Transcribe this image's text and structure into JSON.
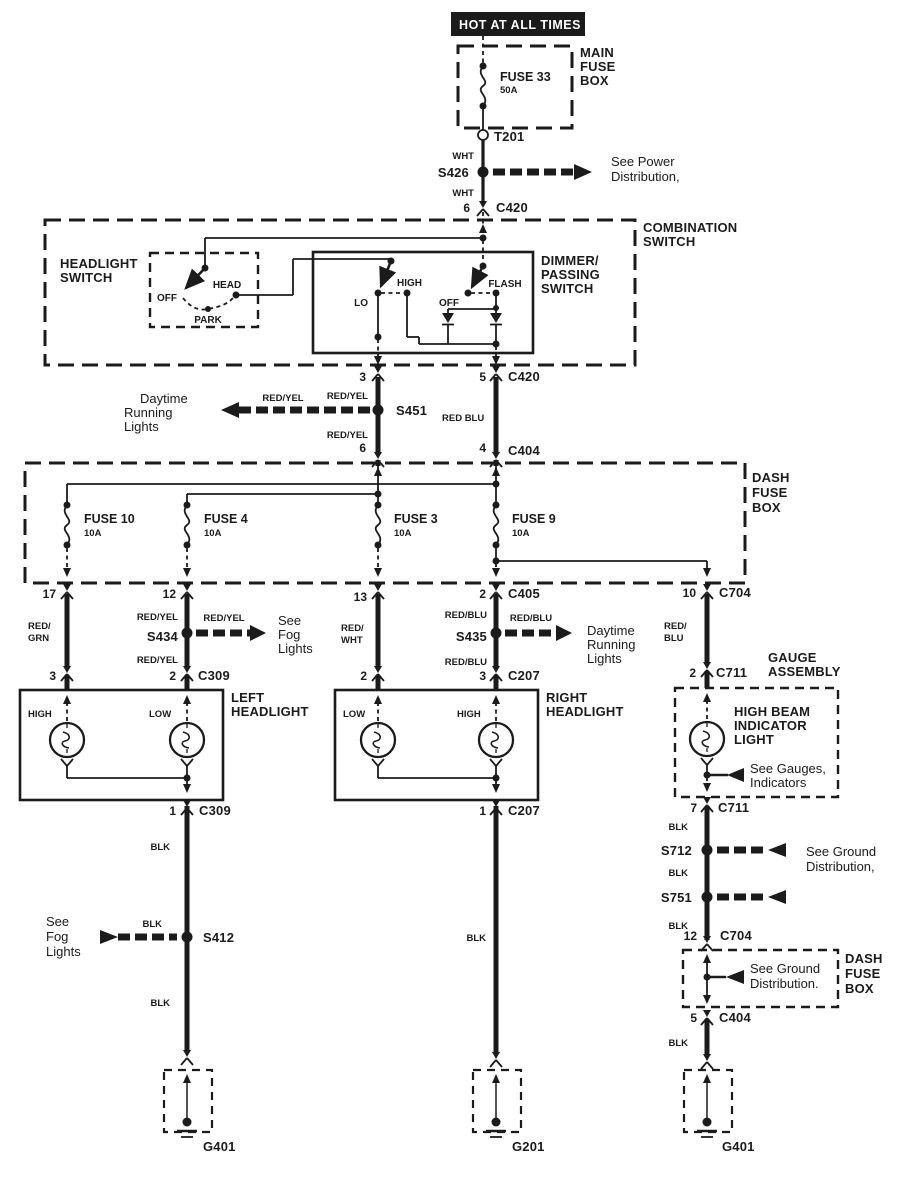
{
  "banner": {
    "text": "HOT AT ALL TIMES"
  },
  "wire": {
    "blk": "BLK",
    "wht": "WHT",
    "red_yel": "RED/YEL",
    "red_blu": "RED/BLU",
    "red_blu_sp": "RED BLU",
    "red1": "RED/",
    "grn": "GRN",
    "wht2": "WHT",
    "blu": "BLU"
  },
  "top": {
    "box_title": [
      "MAIN",
      "FUSE",
      "BOX"
    ],
    "fuse_name": "FUSE 33",
    "fuse_rating": "50A",
    "t201": "T201",
    "s426": "S426",
    "see_power": [
      "See Power",
      "Distribution,"
    ],
    "pin6": "6",
    "c420": "C420"
  },
  "combo": {
    "title": [
      "COMBINATION",
      "SWITCH"
    ],
    "headlight": {
      "title": [
        "HEADLIGHT",
        "SWITCH"
      ],
      "off": "OFF",
      "head": "HEAD",
      "park": "PARK"
    },
    "dimmer": {
      "title": [
        "DIMMER/",
        "PASSING",
        "SWITCH"
      ],
      "lo": "LO",
      "high": "HIGH",
      "off": "OFF",
      "flash": "FLASH"
    }
  },
  "s451_section": {
    "pin3": "3",
    "pin5": "5",
    "c420": "C420",
    "s451": "S451",
    "daytime": [
      "Daytime",
      "Running",
      "Lights"
    ],
    "pin6": "6",
    "pin4": "4",
    "c404": "C404"
  },
  "dashbox": {
    "title": [
      "DASH",
      "FUSE",
      "BOX"
    ],
    "fuses": [
      {
        "name": "FUSE 10",
        "rating": "10A"
      },
      {
        "name": "FUSE 4",
        "rating": "10A"
      },
      {
        "name": "FUSE 3",
        "rating": "10A"
      },
      {
        "name": "FUSE 9",
        "rating": "10A"
      }
    ]
  },
  "row1": {
    "pin17": "17",
    "pin12": "12",
    "pin13": "13",
    "pin2": "2",
    "c405": "C405",
    "pin10": "10",
    "c704": "C704"
  },
  "branches": {
    "s434": "S434",
    "see_fog": [
      "See",
      "Fog",
      "Lights"
    ],
    "s435": "S435",
    "daytime": [
      "Daytime",
      "Running",
      "Lights"
    ]
  },
  "row2": {
    "pin3": "3",
    "pin2a": "2",
    "c309": "C309",
    "pin2b": "2",
    "pin3b": "3",
    "c207": "C207",
    "pin2c": "2",
    "c711": "C711"
  },
  "lh": {
    "title": [
      "LEFT",
      "HEADLIGHT"
    ],
    "high": "HIGH",
    "low": "LOW",
    "pin1": "1",
    "c309": "C309"
  },
  "rh": {
    "title": [
      "RIGHT",
      "HEADLIGHT"
    ],
    "low": "LOW",
    "high": "HIGH",
    "pin1": "1",
    "c207": "C207"
  },
  "gauge": {
    "title": [
      "GAUGE",
      "ASSEMBLY"
    ],
    "lamp": [
      "HIGH BEAM",
      "INDICATOR",
      "LIGHT"
    ],
    "see": [
      "See Gauges,",
      "Indicators"
    ],
    "pin7": "7",
    "c711": "C711"
  },
  "leftcol": {
    "s412": "S412",
    "see_fog": [
      "See",
      "Fog",
      "Lights"
    ],
    "g401": "G401"
  },
  "midcol": {
    "g201": "G201"
  },
  "rightcol": {
    "s712": "S712",
    "s751": "S751",
    "see_ground": [
      "See Ground",
      "Distribution,"
    ],
    "pin12": "12",
    "c704": "C704",
    "box2": {
      "title": [
        "DASH",
        "FUSE",
        "BOX"
      ],
      "see_ground": [
        "See Ground",
        "Distribution."
      ]
    },
    "pin5": "5",
    "c404": "C404",
    "g401": "G401"
  }
}
